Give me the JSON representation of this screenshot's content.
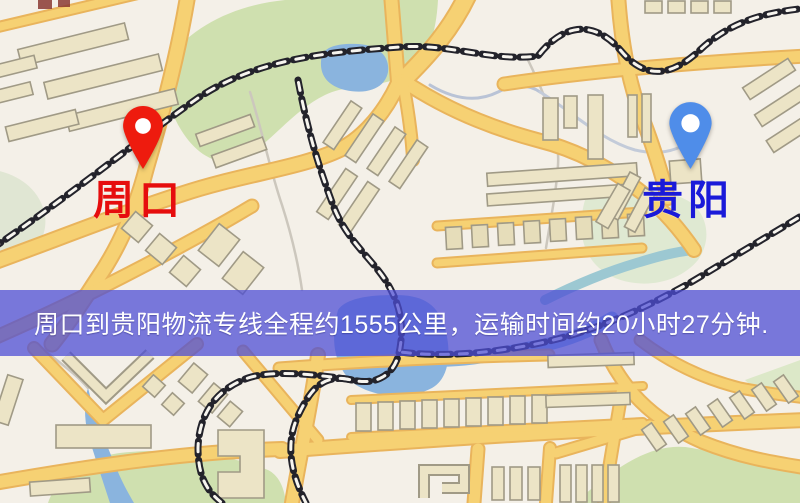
{
  "route_banner": {
    "text": "周口到贵阳物流专线全程约1555公里，运输时间约20小时27分钟.",
    "background_color": "#4d4dd5",
    "text_color": "#ffffff"
  },
  "route": {
    "origin": "周口",
    "destination": "贵阳",
    "distance": "约1555公里",
    "duration": "约20小时27分钟"
  },
  "pins": {
    "origin": {
      "label": "周口",
      "label_color": "#e60d0d",
      "pin_color": "#ee1b0e",
      "icon": "map-pin-icon"
    },
    "destination": {
      "label": "贵阳",
      "label_color": "#1a1ad9",
      "pin_color": "#4f8de9",
      "icon": "map-pin-icon"
    }
  },
  "map": {
    "colors": {
      "background": "#f4f0e8",
      "road_fill": "#f6d173",
      "road_casing": "#e9b45c",
      "building_fill": "#ece4c6",
      "building_outline": "#a09a86",
      "park_green": "#cfe0af",
      "water_blue": "#8ab4de",
      "railway_dark": "#23232b"
    }
  }
}
